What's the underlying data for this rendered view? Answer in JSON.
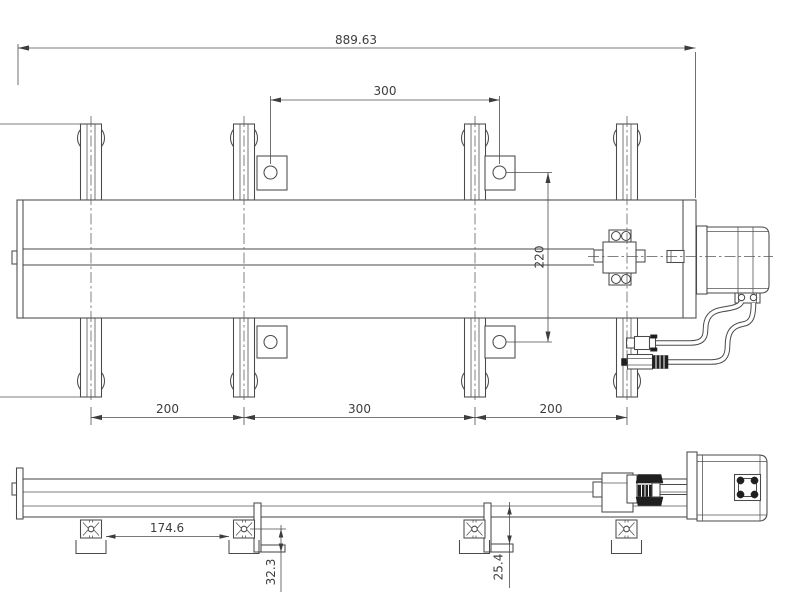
{
  "colors": {
    "line": "#4a4a4a",
    "dim_text": "#3d3d3d",
    "dark_fill": "#1f1f1f",
    "background": "#ffffff"
  },
  "dims": {
    "overall_length": "889.63",
    "sensor_pitch_top": "300",
    "table_width": "220",
    "foot_pitch_left": "200",
    "foot_pitch_mid": "300",
    "foot_pitch_right": "200",
    "base_plate_gap": "174.6",
    "bracket_drop": "32.3",
    "rail_to_bracket": "25.4"
  }
}
